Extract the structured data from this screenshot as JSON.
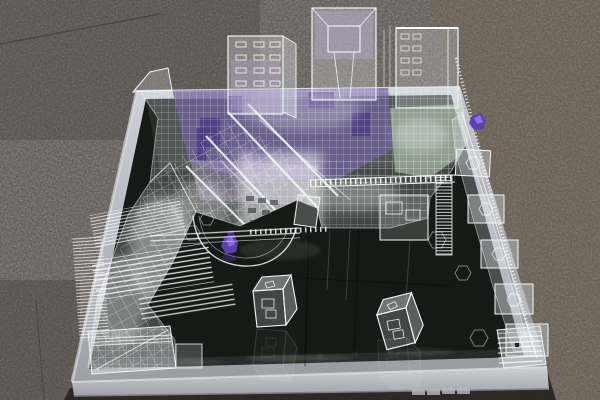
{
  "scene": {
    "type": "photograph",
    "subject": "Transparent acrylic architectural scale model with purple accents displayed on a mirror-topped table",
    "setting": "speckled granite floor, photographed from a high frontal angle",
    "objects": {
      "floor": "gray-brown speckled granite tiles with faint seams",
      "table": "square mirrored table with brushed aluminum frame and shadow beneath",
      "model": "dense laser-cut clear acrylic city model: lattice blocks, louvered diagonal slab, walkways, curved ramp",
      "towers": "three translucent box towers along the back edge, center one with inner pyramid",
      "accents": "purple acrylic interior pieces, two small purple gem figures",
      "cubes": "two small clear acrylic cubes resting on the open mirror with reflections",
      "etchings": "hexagonal outlines etched into the mirror surface"
    },
    "counts": {
      "towers": 3,
      "clear_cubes": 2,
      "purple_gems": 2,
      "hexagon_etchings": 5
    },
    "palette": {
      "floor_base": "#57514a",
      "floor_warm": "#74624e",
      "floor_dark": "#46423c",
      "shadow": "#211f1b",
      "frame_silver": "#b2b3bb",
      "frame_face": "#c6c7cd",
      "frame_highlight": "#dcdde2",
      "mirror": "#161a16",
      "mirror_sheen": "#4a514b",
      "acrylic_line": "#f2f7f9",
      "acrylic_fill": "#e2ecf2",
      "purple_main": "#70619e",
      "purple_deep": "#4b3a82",
      "purple_pale": "#b7a6d2",
      "green_tint": "#c3d8c0",
      "gem_purple": "#5d3fb0",
      "gem_light": "#8f72dd"
    }
  }
}
